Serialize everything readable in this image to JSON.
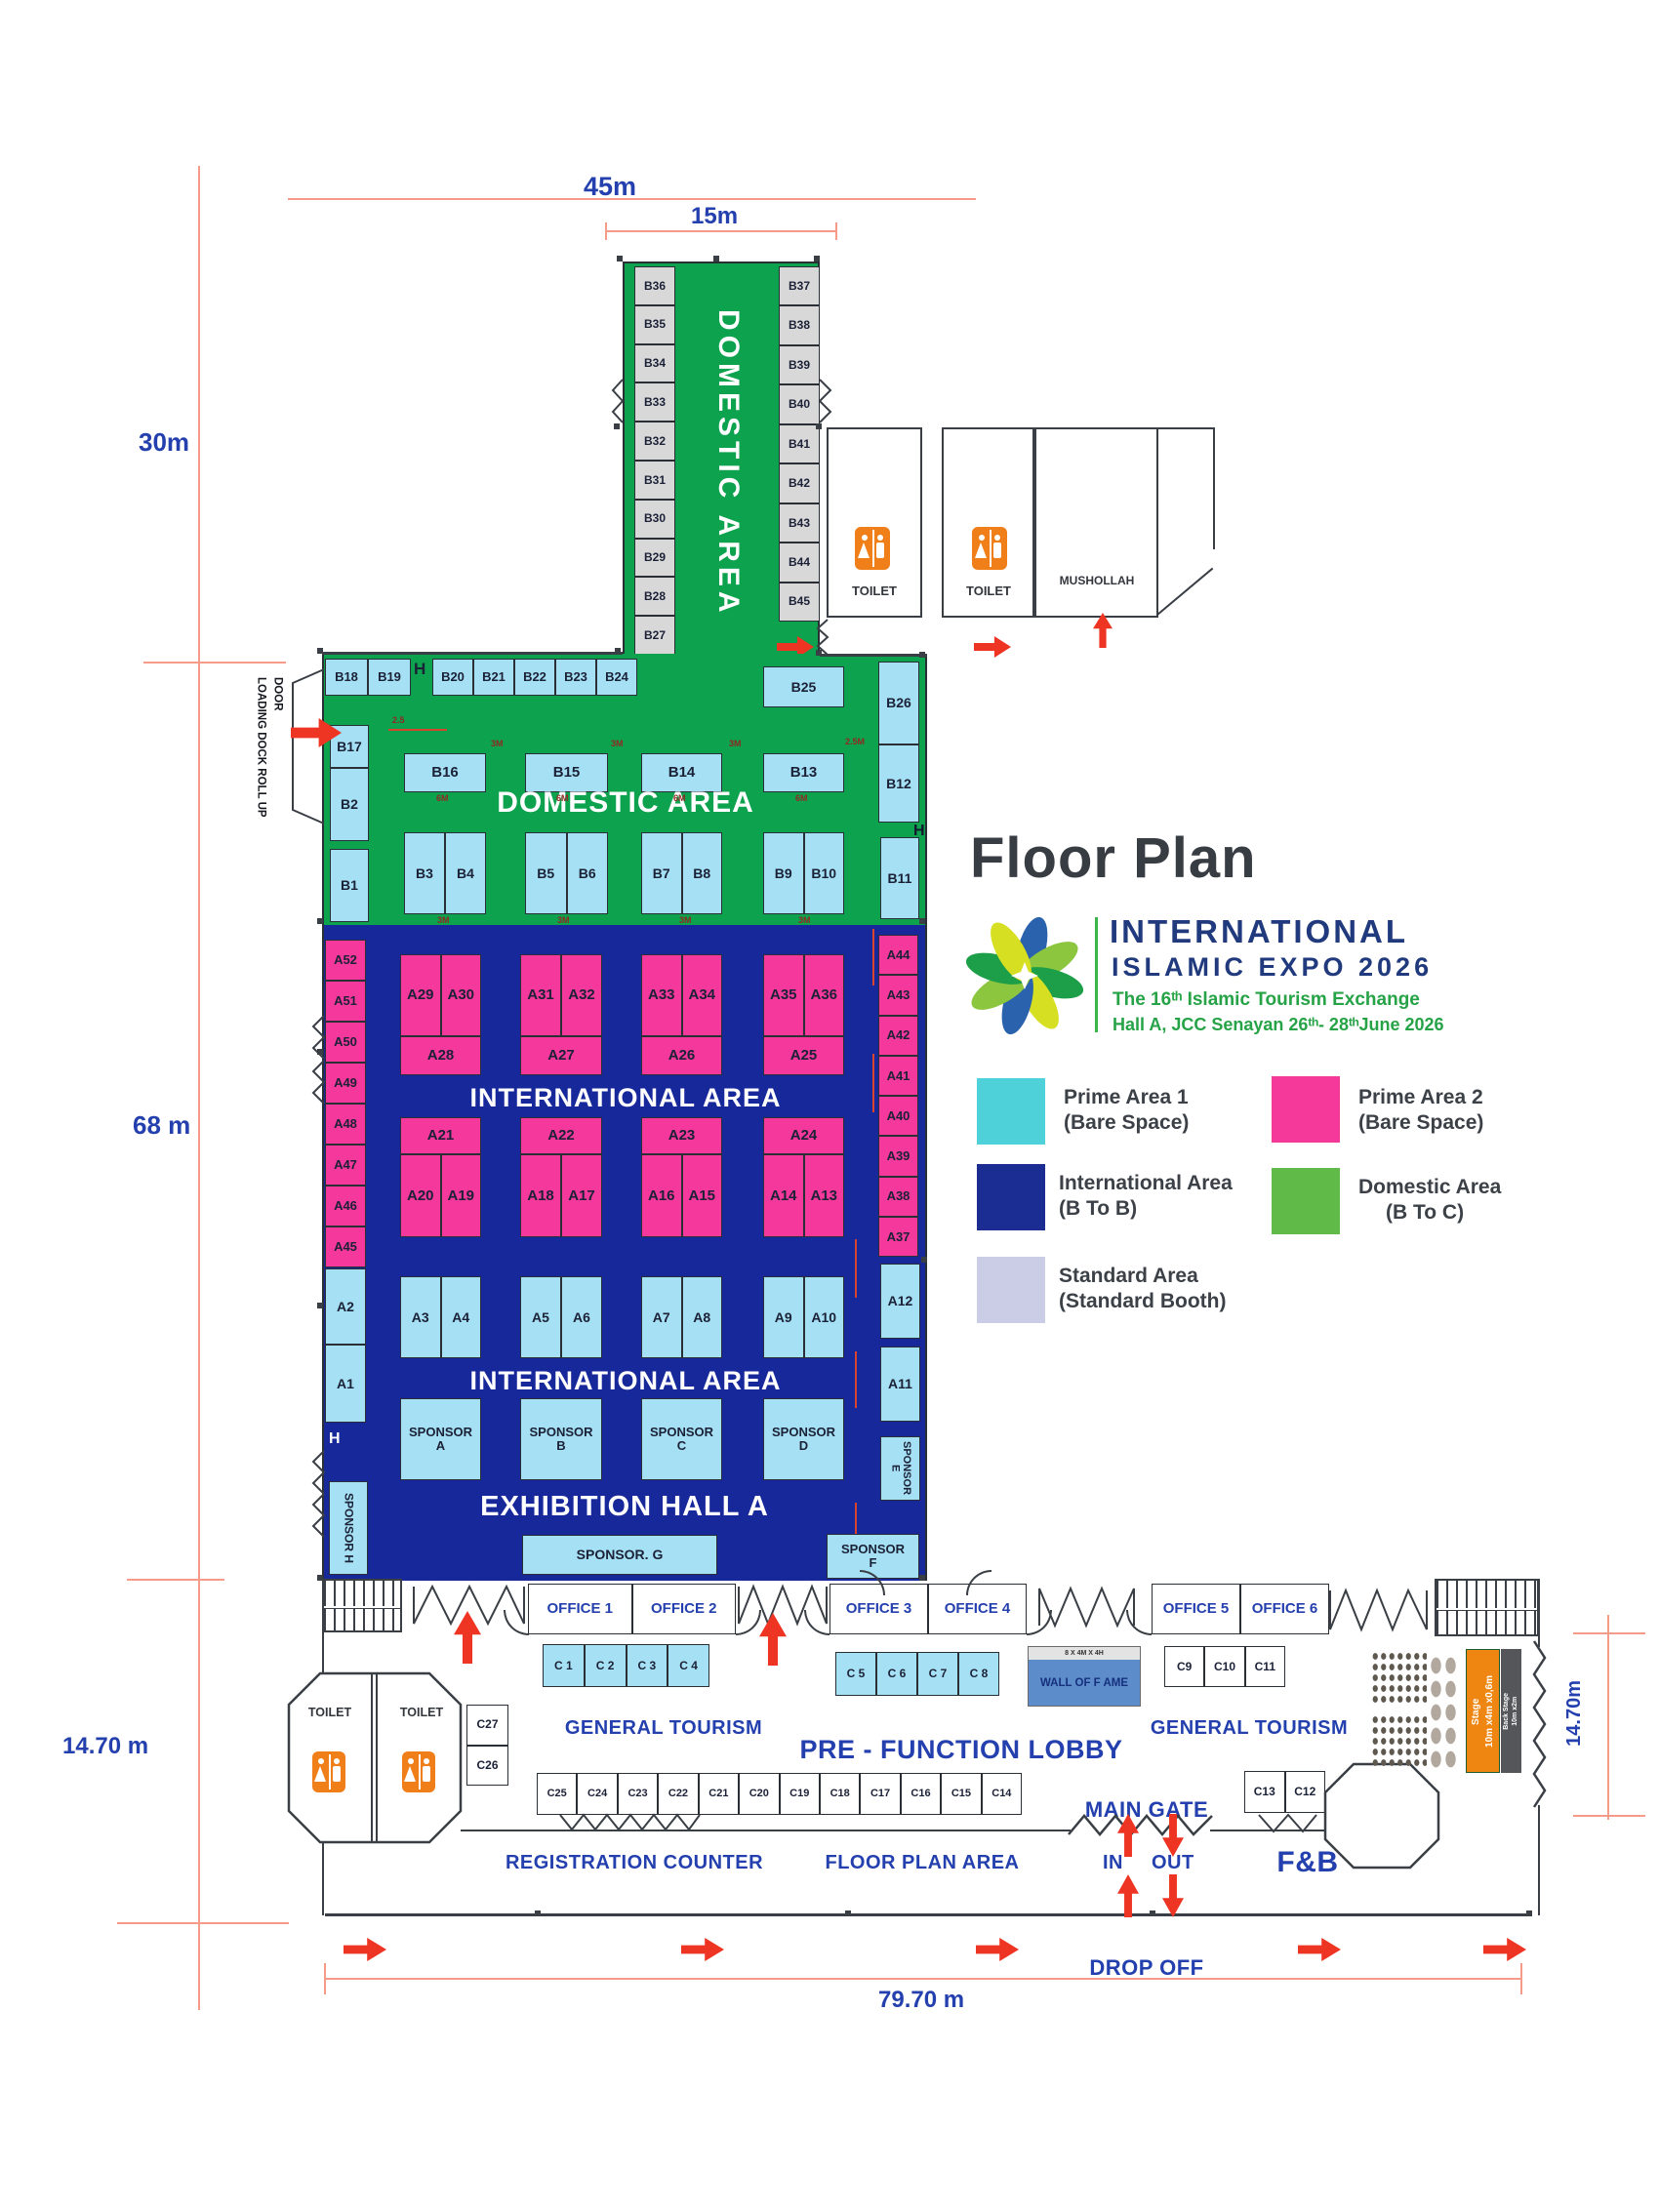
{
  "title": "Floor Plan",
  "colors": {
    "plan_green": "#0ca24e",
    "plan_blue": "#17289a",
    "booth_cyan": "#a6e0f4",
    "booth_pink": "#f5389b",
    "booth_grey": "#d8d8d8",
    "stage_orange": "#ee8611",
    "backstage_grey": "#55565a",
    "wof_blue": "#5d8ccb",
    "arrow_red": "#ee3524",
    "legend_prime1": "#4fd1d9",
    "legend_prime2": "#f4399a",
    "legend_intl": "#1b2d93",
    "legend_domestic": "#5fba47",
    "legend_standard": "#cbcce6"
  },
  "dims": {
    "d45": "45m",
    "d15": "15m",
    "d30": "30m",
    "d68": "68 m",
    "d1470_left": "14.70 m",
    "d1470_right": "14.70m",
    "d7970": "79.70 m"
  },
  "dims_small": [
    "2.5",
    "3M",
    "3M",
    "3M",
    "6M",
    "6M",
    "6M",
    "6M",
    "3M",
    "3M",
    "3M",
    "3M",
    "2.5M",
    "3M",
    "3M",
    "3M",
    "3M"
  ],
  "logo": {
    "line1": "INTERNATIONAL",
    "line2": "ISLAMIC  EXPO  2026",
    "line3": "The 16ᵗʰ Islamic Tourism Exchange",
    "line4": "Hall A, JCC Senayan 26ᵗʰ- 28ᵗʰJune 2026"
  },
  "legend": {
    "prime1_l1": "Prime Area  1",
    "prime1_l2": "(Bare Space)",
    "prime2_l1": "Prime Area  2",
    "prime2_l2": "(Bare Space)",
    "intl_l1": "International Area",
    "intl_l2": "(B To B)",
    "dom_l1": "Domestic Area",
    "dom_l2": "(B To C)",
    "std_l1": "Standard Area",
    "std_l2": "(Standard Booth)"
  },
  "corridor": {
    "label": "DOMESTIC AREA",
    "left": [
      "B36",
      "B35",
      "B34",
      "B33",
      "B32",
      "B31",
      "B30",
      "B29",
      "B28",
      "B27"
    ],
    "right": [
      "B37",
      "B38",
      "B39",
      "B40",
      "B41",
      "B42",
      "B43",
      "B44",
      "B45"
    ]
  },
  "toilets": {
    "t1": "TOILET",
    "t2": "TOILET",
    "mushollah": "MUSHOLLAH",
    "t3": "TOILET",
    "t4": "TOILET"
  },
  "domestic": {
    "label": "DOMESTIC AREA",
    "top_left": [
      "B18",
      "B19"
    ],
    "top_right": [
      "B20",
      "B21",
      "B22",
      "B23",
      "B24"
    ],
    "b25": "B25",
    "b26": "B26",
    "b17": "B17",
    "b2": "B2",
    "b1": "B1",
    "mid": [
      "B16",
      "B15",
      "B14",
      "B13"
    ],
    "b12": "B12",
    "pairs": [
      [
        "B3",
        "B4"
      ],
      [
        "B5",
        "B6"
      ],
      [
        "B7",
        "B8"
      ],
      [
        "B9",
        "B10"
      ]
    ],
    "b11": "B11",
    "loading1": "LOADING DOCK",
    "loading2": "ROLL UP DOOR",
    "hydrant1": "H",
    "hydrant2": "H",
    "hydrant3": "H"
  },
  "intl": {
    "area_label1": "INTERNATIONAL AREA",
    "area_label2": "INTERNATIONAL AREA",
    "hall_label": "EXHIBITION HALL A",
    "left_col": [
      "A52",
      "A51",
      "A50",
      "A49",
      "A48",
      "A47",
      "A46",
      "A45"
    ],
    "right_col": [
      "A44",
      "A43",
      "A42",
      "A41",
      "A40",
      "A39",
      "A38",
      "A37"
    ],
    "a2": "A2",
    "a1": "A1",
    "a12": "A12",
    "a11": "A11",
    "g1": [
      {
        "top": [
          "A29",
          "A30"
        ],
        "bot": "A28"
      },
      {
        "top": [
          "A31",
          "A32"
        ],
        "bot": "A27"
      },
      {
        "top": [
          "A33",
          "A34"
        ],
        "bot": "A26"
      },
      {
        "top": [
          "A35",
          "A36"
        ],
        "bot": "A25"
      }
    ],
    "g2": [
      {
        "top": "A21",
        "bot": [
          "A20",
          "A19"
        ]
      },
      {
        "top": "A22",
        "bot": [
          "A18",
          "A17"
        ]
      },
      {
        "top": "A23",
        "bot": [
          "A16",
          "A15"
        ]
      },
      {
        "top": "A24",
        "bot": [
          "A14",
          "A13"
        ]
      }
    ],
    "row3": [
      [
        "A3",
        "A4"
      ],
      [
        "A5",
        "A6"
      ],
      [
        "A7",
        "A8"
      ],
      [
        "A9",
        "A10"
      ]
    ],
    "sponsors": [
      [
        "SPONSOR",
        "A"
      ],
      [
        "SPONSOR",
        "B"
      ],
      [
        "SPONSOR",
        "C"
      ],
      [
        "SPONSOR",
        "D"
      ]
    ],
    "sponsor_e": "SPONSOR E",
    "sponsor_f1": "SPONSOR",
    "sponsor_f2": "F",
    "sponsor_g": "SPONSOR. G",
    "sponsor_h": "SPONSOR H"
  },
  "lobby": {
    "offices_a": [
      "OFFICE 1",
      "OFFICE 2"
    ],
    "offices_b": [
      "OFFICE 3",
      "OFFICE 4"
    ],
    "offices_c": [
      "OFFICE 5",
      "OFFICE 6"
    ],
    "c1": [
      "C 1",
      "C 2",
      "C 3",
      "C 4"
    ],
    "c2": [
      "C 5",
      "C 6",
      "C 7",
      "C 8"
    ],
    "c3": [
      "C9",
      "C10",
      "C11"
    ],
    "c4": [
      "C25",
      "C24",
      "C23",
      "C22",
      "C21",
      "C20",
      "C19",
      "C18",
      "C17",
      "C16",
      "C15",
      "C14"
    ],
    "c_pair": [
      "C13",
      "C12"
    ],
    "c_stack": [
      "C27",
      "C26"
    ],
    "wof_size": "8 X 4M X 4H",
    "wof": "WALL OF F AME",
    "gt_left": "GENERAL TOURISM",
    "gt_right": "GENERAL TOURISM",
    "prefunction": "PRE - FUNCTION LOBBY",
    "registration": "REGISTRATION COUNTER",
    "fpa": "FLOOR PLAN AREA",
    "main_gate": "MAIN GATE",
    "in": "IN",
    "out": "OUT",
    "drop_off": "DROP OFF",
    "fnb": "F&B",
    "stage1": "Stage",
    "stage2": "10m x4m x0,6m",
    "back1": "Back Stage",
    "back2": "10m x2m"
  }
}
